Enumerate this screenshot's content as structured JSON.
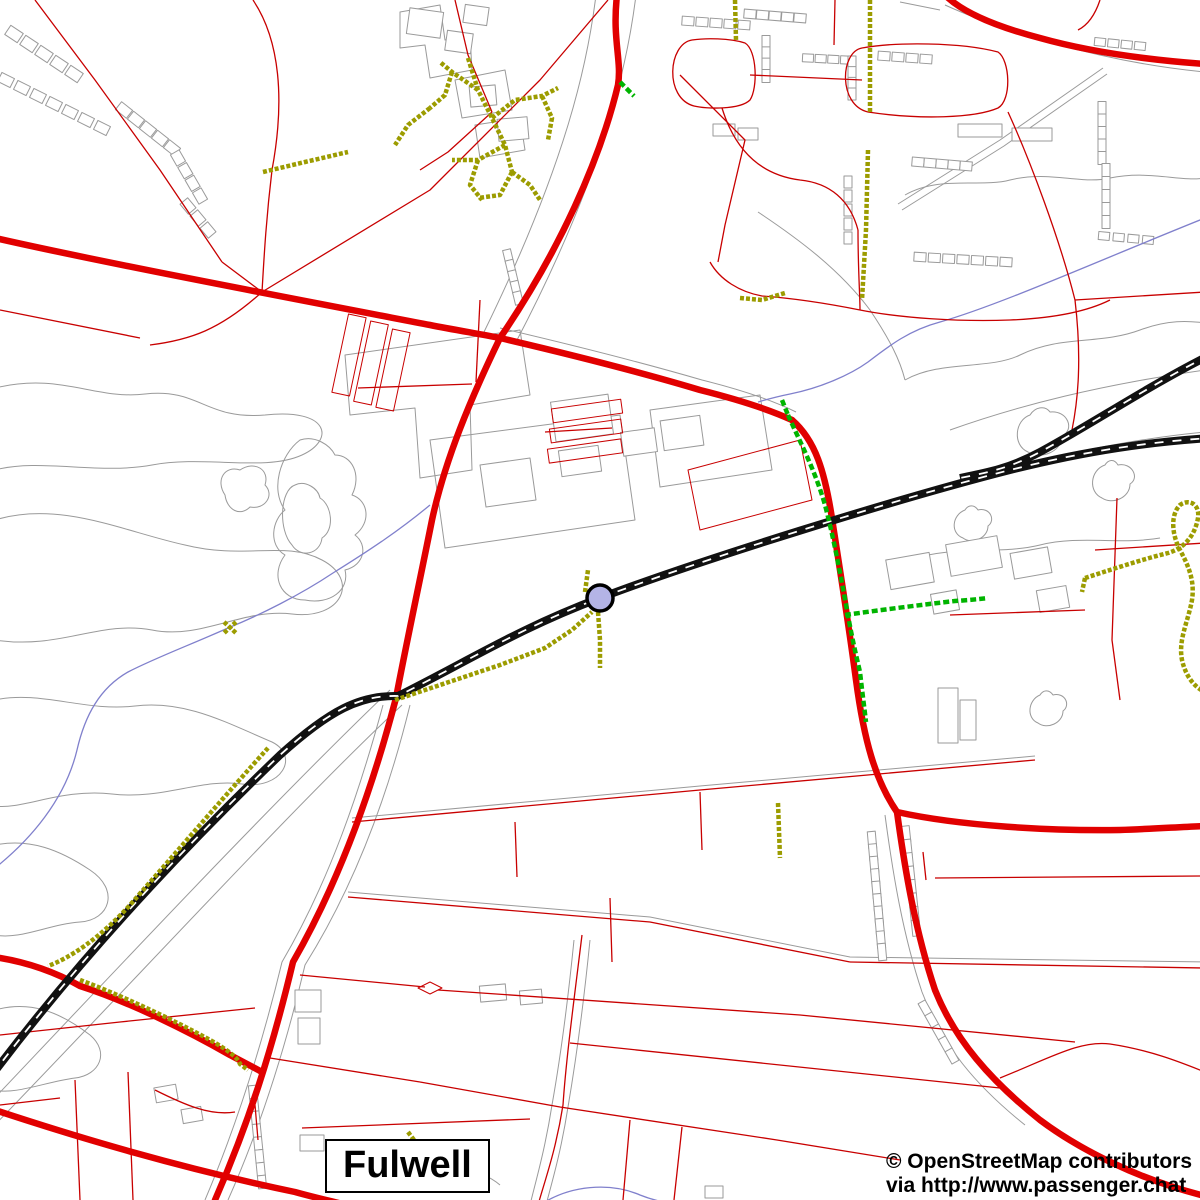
{
  "map": {
    "width": 1200,
    "height": 1200,
    "background": "#ffffff",
    "place_label": "Fulwell",
    "attribution": {
      "line1": "© OpenStreetMap contributors",
      "line2": "via http://www.passenger.chat"
    },
    "station": {
      "name": "railway-station",
      "cx": 600,
      "cy": 598,
      "r": 13,
      "fill": "#b4b4e6",
      "stroke": "#000000",
      "stroke_width": 3.5
    },
    "colors": {
      "road_major": "#e10000",
      "road_minor": "#c80000",
      "path": "#9c9c00",
      "route": "#00b400",
      "railway": "#111111",
      "stream": "#8080cc",
      "outline": "#9a9a9a"
    },
    "layers": [
      {
        "name": "area-outlines",
        "color": "#9a9a9a",
        "width": 1,
        "paths": [
          "M-5,388 C60,372 95,400 145,394 C200,388 205,420 265,415 C330,408 335,440 302,455 C265,472 205,455 152,465 C98,475 40,458 -5,470",
          "M-5,520 C60,500 125,532 185,545 C245,560 285,540 322,560 C360,580 342,620 292,614 C242,608 202,640 152,630 C100,620 60,650 -5,640",
          "M225,495 C215,480 225,465 240,470 C255,460 270,470 265,485 C275,495 265,510 250,507 C240,517 227,510 225,495 Z",
          "M295,485 C280,490 278,530 292,545 C300,558 320,555 322,538 C335,530 332,505 320,498 C318,488 305,480 295,485 Z",
          "M-5,700 C40,690 85,712 135,706 C185,700 225,722 272,742 C300,756 282,790 242,784 C202,778 162,800 112,794 C62,788 22,810 -5,806",
          "M-5,845 C30,838 60,850 90,870 C120,890 110,920 80,922 C50,924 20,940 -5,935",
          "M-5,1010 C30,1000 60,1012 90,1035 C110,1052 100,1075 75,1078 C45,1082 15,1095 -5,1090",
          "M300,440 C280,455 270,490 285,510 C272,520 268,545 285,555 C270,575 280,600 305,600 C330,605 350,590 345,570 C365,565 368,545 355,535 C372,522 368,500 352,495 C362,475 352,455 335,455 C330,445 315,435 300,440 Z",
          "M898,204 L1000,140 L1103,68",
          "M902,210 L1004,146 L1107,74",
          "M905,195 C940,175 980,188 1010,180 C1050,170 1080,185 1110,178 C1150,170 1180,182 1205,178",
          "M758,212 C800,240 840,270 870,310 C890,340 900,360 905,380",
          "M905,380 C940,360 990,370 1020,355 C1060,335 1100,345 1140,330 C1180,315 1205,325 1205,322",
          "M910,560 C950,545 1000,555 1040,545 C1080,535 1120,545 1160,538",
          "M1030,415 C1015,420 1012,445 1028,452 C1040,460 1062,452 1062,436 C1075,430 1068,410 1050,412 C1045,405 1035,407 1030,415 Z",
          "M1105,465 C1090,470 1088,492 1102,498 C1112,505 1130,498 1130,484 C1140,478 1132,462 1118,465 C1114,458 1108,460 1105,465 Z",
          "M965,510 C952,515 950,533 963,538 C972,545 988,538 988,526 C996,520 990,507 978,510 C974,504 968,505 965,510 Z",
          "M1040,695 C1028,700 1026,718 1038,723 C1047,730 1063,723 1063,711 C1071,705 1065,692 1053,695 C1049,689 1043,690 1040,695 Z",
          "M950,430 C1020,405 1100,385 1205,370",
          "M940,490 C1020,462 1120,440 1205,432",
          "M945,5 C1000,30 1100,62 1205,72",
          "M900,2 L940,10",
          "M596,-5 C588,60 568,160 484,332",
          "M636,-5 C628,60 606,170 516,342",
          "M500,328 C560,342 640,362 702,380 C742,390 772,400 796,412",
          "M400,12 L440,5 L445,40 L470,36 L472,70 L430,78 L425,45 L400,48 Z",
          "M455,80 L505,70 L512,110 L462,118 Z",
          "M475,125 L520,118 L525,150 L480,158 Z",
          "M345,355 L520,330 L530,395 L470,405 L472,470 L420,478 L415,408 L350,415 Z",
          "M430,440 L620,415 L635,520 L445,548 Z",
          "M650,410 L760,395 L772,470 L660,487 Z",
          "M480,465 L530,458 L536,500 L486,507 Z",
          "M-12,1105 C130,955 280,795 390,690",
          "M-12,1132 C140,975 300,800 402,705",
          "M352,818 L700,786 L1035,756",
          "M348,892 L650,917 L850,957 L1205,962",
          "M383,705 C360,790 330,880 282,962 C262,1045 238,1122 205,1200",
          "M410,705 C388,795 355,885 305,965 C285,1050 260,1128 228,1200",
          "M885,815 C893,875 903,935 922,992 C942,1045 975,1085 1025,1125",
          "M574,940 C568,1000 560,1060 552,1105 C545,1150 536,1180 530,1205",
          "M590,940 C584,1000 576,1060 568,1107 C561,1152 552,1182 546,1205",
          "M420,1185 C450,1165 480,1168 500,1185"
        ]
      },
      {
        "name": "buildings",
        "color": "#9a9a9a",
        "width": 1,
        "fill": "#ffffff",
        "rects": [
          [
            408,
            10,
            34,
            26,
            8
          ],
          [
            446,
            32,
            26,
            20,
            8
          ],
          [
            464,
            6,
            24,
            18,
            8
          ],
          [
            470,
            86,
            26,
            20,
            -5
          ],
          [
            498,
            118,
            30,
            22,
            -5
          ],
          [
            553,
            398,
            58,
            40,
            -8
          ],
          [
            560,
            448,
            40,
            26,
            -8
          ],
          [
            622,
            430,
            34,
            24,
            -8
          ],
          [
            662,
            418,
            40,
            30,
            -8
          ],
          [
            888,
            556,
            44,
            30,
            -10
          ],
          [
            948,
            540,
            52,
            32,
            -10
          ],
          [
            1012,
            550,
            38,
            26,
            -10
          ],
          [
            932,
            592,
            26,
            20,
            -10
          ],
          [
            1038,
            588,
            30,
            22,
            -10
          ],
          [
            938,
            688,
            20,
            55,
            0
          ],
          [
            960,
            700,
            16,
            40,
            0
          ],
          [
            295,
            990,
            26,
            22,
            0
          ],
          [
            298,
            1018,
            22,
            26,
            0
          ],
          [
            480,
            985,
            26,
            16,
            -5
          ],
          [
            520,
            990,
            22,
            14,
            -5
          ],
          [
            705,
            1186,
            18,
            12,
            0
          ],
          [
            300,
            1135,
            24,
            16,
            0
          ],
          [
            155,
            1086,
            22,
            15,
            -10
          ],
          [
            182,
            1108,
            20,
            14,
            -10
          ],
          [
            713,
            124,
            22,
            12,
            0
          ],
          [
            738,
            128,
            20,
            12,
            0
          ],
          [
            958,
            124,
            44,
            13,
            0
          ],
          [
            1012,
            128,
            40,
            13,
            0
          ]
        ],
        "strips": [
          {
            "x1": 14,
            "y1": 34,
            "x2": 74,
            "y2": 74,
            "n": 5,
            "bw": 15,
            "bh": 11
          },
          {
            "x1": 6,
            "y1": 80,
            "x2": 102,
            "y2": 128,
            "n": 7,
            "bw": 14,
            "bh": 10
          },
          {
            "x1": 124,
            "y1": 110,
            "x2": 172,
            "y2": 148,
            "n": 5,
            "bw": 14,
            "bh": 10
          },
          {
            "x1": 178,
            "y1": 158,
            "x2": 200,
            "y2": 196,
            "n": 4,
            "bw": 13,
            "bh": 10
          },
          {
            "x1": 188,
            "y1": 206,
            "x2": 208,
            "y2": 230,
            "n": 3,
            "bw": 13,
            "bh": 10
          },
          {
            "x1": 688,
            "y1": 21,
            "x2": 744,
            "y2": 25,
            "n": 5,
            "bw": 12,
            "bh": 9
          },
          {
            "x1": 750,
            "y1": 14,
            "x2": 800,
            "y2": 18,
            "n": 5,
            "bw": 12,
            "bh": 9
          },
          {
            "x1": 766,
            "y1": 42,
            "x2": 766,
            "y2": 76,
            "n": 4,
            "bw": 13,
            "bh": 8
          },
          {
            "x1": 808,
            "y1": 58,
            "x2": 846,
            "y2": 60,
            "n": 4,
            "bw": 11,
            "bh": 8
          },
          {
            "x1": 852,
            "y1": 62,
            "x2": 852,
            "y2": 94,
            "n": 4,
            "bw": 12,
            "bh": 8
          },
          {
            "x1": 884,
            "y1": 56,
            "x2": 926,
            "y2": 59,
            "n": 4,
            "bw": 12,
            "bh": 9
          },
          {
            "x1": 918,
            "y1": 162,
            "x2": 966,
            "y2": 166,
            "n": 5,
            "bw": 12,
            "bh": 9
          },
          {
            "x1": 848,
            "y1": 182,
            "x2": 848,
            "y2": 238,
            "n": 5,
            "bw": 12,
            "bh": 8
          },
          {
            "x1": 920,
            "y1": 257,
            "x2": 1006,
            "y2": 262,
            "n": 7,
            "bw": 12,
            "bh": 9
          },
          {
            "x1": 1100,
            "y1": 42,
            "x2": 1140,
            "y2": 46,
            "n": 4,
            "bw": 11,
            "bh": 8
          },
          {
            "x1": 1102,
            "y1": 108,
            "x2": 1102,
            "y2": 158,
            "n": 5,
            "bw": 13,
            "bh": 8
          },
          {
            "x1": 1106,
            "y1": 170,
            "x2": 1106,
            "y2": 222,
            "n": 5,
            "bw": 13,
            "bh": 8
          },
          {
            "x1": 1104,
            "y1": 236,
            "x2": 1148,
            "y2": 240,
            "n": 4,
            "bw": 11,
            "bh": 8
          },
          {
            "x1": 508,
            "y1": 256,
            "x2": 518,
            "y2": 298,
            "n": 5,
            "bw": 13,
            "bh": 8
          },
          {
            "x1": 872,
            "y1": 840,
            "x2": 882,
            "y2": 952,
            "n": 10,
            "bw": 17,
            "bh": 8
          },
          {
            "x1": 906,
            "y1": 834,
            "x2": 916,
            "y2": 928,
            "n": 8,
            "bw": 16,
            "bh": 8
          },
          {
            "x1": 925,
            "y1": 1008,
            "x2": 952,
            "y2": 1056,
            "n": 5,
            "bw": 14,
            "bh": 8
          },
          {
            "x1": 253,
            "y1": 1092,
            "x2": 262,
            "y2": 1182,
            "n": 8,
            "bw": 13,
            "bh": 8
          }
        ]
      },
      {
        "name": "streams",
        "color": "#8080cc",
        "width": 1.3,
        "paths": [
          "M1205,218 C1100,260 1000,305 940,322 C910,330 890,345 868,362 C850,375 820,388 790,394 C775,397 765,400 758,402",
          "M430,505 C400,530 370,550 333,573 C300,595 260,615 228,628 C190,645 155,658 128,672 C100,688 85,715 77,750 C65,800 30,840 -5,868",
          "M540,1205 C570,1185 610,1182 640,1195 C660,1203 680,1205 690,1205"
        ]
      },
      {
        "name": "roads-minor",
        "color": "#c80000",
        "width": 1.3,
        "paths": [
          "M35,0 L95,80 L160,170 L222,262",
          "M253,0 C280,40 285,100 272,170 C266,220 264,258 262,292",
          "M608,0 L540,80 L430,190 L262,292",
          "M262,292 L222,262",
          "M262,292 C220,330 190,340 150,345",
          "M455,0 L468,55 L492,112",
          "M492,112 L448,152 L420,170",
          "M680,75 L745,140 L725,225 L718,262",
          "M750,75 L862,80",
          "M835,0 L834,45",
          "M722,108 C735,150 760,175 800,180 C830,183 850,200 858,230",
          "M858,230 C858,270 860,295 860,310",
          "M860,310 C900,318 960,322 1010,320 C1060,318 1090,310 1110,300",
          "M860,310 C820,302 790,298 762,296 C740,292 720,280 710,262",
          "M1008,112 C1030,160 1060,240 1075,300 C1082,360 1078,400 1072,430",
          "M1075,300 L1205,292",
          "M1100,0 C1095,15 1088,25 1078,30",
          "M1117,498 L1112,640 L1120,700",
          "M1095,550 L1205,543",
          "M950,615 L1085,610",
          "M935,878 L1205,876",
          "M850,962 L1205,968",
          "M1000,1078 C1050,1058 1080,1040 1110,1044 C1150,1050 1180,1062 1205,1072",
          "M352,822 L700,790 L1035,760",
          "M348,897 L650,922 L850,962",
          "M515,822 L517,877",
          "M610,898 L612,962",
          "M700,792 L702,850",
          "M923,852 L926,880",
          "M0,1035 L120,1022 L255,1008",
          "M75,1080 L80,1200",
          "M128,1072 L133,1200",
          "M0,1105 L60,1098",
          "M302,1128 L530,1119",
          "M255,1105 L258,1140",
          "M582,935 C574,1000 566,1060 563,1105 C556,1150 545,1180 538,1205",
          "M300,975 L425,987",
          "M438,990 L800,1015 L1075,1042",
          "M570,1043 L1000,1088",
          "M420,1082 L560,1107 L777,1140 L900,1160",
          "M630,1120 L623,1200",
          "M682,1127 L674,1200",
          "M270,1058 L420,1082",
          "M155,1090 C185,1105 210,1116 235,1112",
          "M358,388 L472,384",
          "M476,382 L480,300",
          "M545,432 L612,428",
          "M0,310 C60,322 100,330 140,338",
          "M692,40 C668,44 664,98 694,106 C706,109 740,110 750,100 C758,88 757,50 745,43 C730,38 705,38 692,40 Z",
          "M862,48 C840,52 838,105 868,112 C920,120 975,118 998,108 C1012,100 1010,60 998,52 C960,42 895,42 862,48 Z"
        ]
      },
      {
        "name": "parcel-outlines",
        "color": "#c80000",
        "width": 1,
        "paths": [
          "M688,470 L800,440 L812,500 L700,530 Z",
          "M430,982 L442,988 L430,994 L418,988 Z"
        ],
        "rects": [
          [
            340,
            315,
            18,
            80,
            12
          ],
          [
            362,
            322,
            18,
            82,
            12
          ],
          [
            384,
            330,
            18,
            80,
            12
          ],
          [
            552,
            404,
            70,
            14,
            -8
          ],
          [
            550,
            424,
            72,
            14,
            -8
          ],
          [
            548,
            444,
            74,
            14,
            -8
          ]
        ]
      },
      {
        "name": "roads-major",
        "color": "#e10000",
        "width": 6.5,
        "linecap": "round",
        "paths": [
          "M617,-5 C612,40 622,60 618,85 C600,160 560,250 500,338",
          "M500,338 C470,400 445,460 432,520 C420,580 405,650 396,698",
          "M396,698 C372,790 340,880 293,962 C272,1050 248,1125 215,1200",
          "M-5,238 C100,262 300,300 430,325 C455,330 480,334 500,338",
          "M500,338 C560,352 640,372 700,390 C740,400 770,410 792,420",
          "M792,420 C815,440 825,470 833,525 C840,570 848,620 856,680 C864,740 875,780 897,812",
          "M897,812 C960,826 1050,831 1120,830 C1150,829 1180,827 1205,826",
          "M897,812 C905,870 915,930 935,990 C955,1040 990,1080 1040,1120 C1080,1150 1140,1180 1205,1196",
          "M945,-5 C960,10 990,25 1040,38 C1090,52 1150,60 1205,64",
          "M0,958 C30,963 55,972 80,986 C130,1002 190,1032 230,1055 C245,1063 255,1068 262,1072",
          "M-5,1110 C80,1138 180,1168 295,1192 C320,1199 340,1203 350,1206"
        ]
      },
      {
        "name": "railway-casing",
        "color": "#111111",
        "width": 8,
        "linecap": "butt",
        "paths": [
          "M-8,1075 C60,985 150,880 280,755 C330,710 360,695 398,696 C470,660 520,628 600,598 C700,560 900,498 1010,470 C1090,450 1150,442 1210,438",
          "M1210,355 C1150,385 1090,425 1040,452 C1010,468 990,472 960,478"
        ]
      },
      {
        "name": "railway-dash",
        "color": "#ffffff",
        "width": 1.8,
        "dash": "9 9",
        "paths": [
          "M-8,1075 C60,985 150,880 280,755 C330,710 360,695 398,696 C470,660 520,628 600,598 C700,560 900,498 1010,470 C1090,450 1150,442 1210,438",
          "M1210,355 C1150,385 1090,425 1040,452 C1010,468 990,472 960,478"
        ]
      },
      {
        "name": "footpaths",
        "color": "#9c9c00",
        "width": 4.5,
        "dash": "4 2",
        "paths": [
          "M468,58 L478,90 L492,118 L505,145 L512,172",
          "M478,90 L452,72 L440,62",
          "M452,72 L445,95 L430,108",
          "M430,108 L408,125 L395,145",
          "M492,118 L515,100 L542,96 L558,88",
          "M542,96 L552,118 L548,140",
          "M505,145 L478,160 L452,160",
          "M478,160 L470,185 L482,200",
          "M512,172 L500,195 L478,198",
          "M512,172 L530,185 L540,200",
          "M735,0 L736,40",
          "M870,0 L870,112",
          "M868,150 L866,230 L862,300",
          "M740,298 L762,300 L785,293",
          "M263,172 L305,162 L348,152",
          "M395,700 L440,685 L500,665 L545,648 L572,630 L592,612",
          "M598,612 L600,640 L600,668",
          "M585,592 L588,570",
          "M268,748 C230,790 180,848 130,905 C100,938 70,958 48,966",
          "M80,980 C120,995 170,1018 210,1040 C228,1050 238,1058 240,1064 L248,1070",
          "M1085,578 C1110,570 1140,560 1168,553 C1185,548 1195,535 1198,518 C1200,505 1190,498 1180,505 C1170,515 1172,535 1180,550 C1188,565 1195,580 1192,600 C1188,622 1178,640 1182,660 C1186,678 1196,688 1205,692",
          "M1085,578 L1082,592",
          "M778,803 L780,858",
          "M224,622 L236,633",
          "M236,622 L224,633",
          "M408,1132 L414,1140"
        ]
      },
      {
        "name": "cycle-routes",
        "color": "#00b400",
        "width": 4.5,
        "dash": "6 3",
        "paths": [
          "M782,400 L788,415",
          "M788,415 C800,442 815,470 825,505 C833,535 840,572 847,610 C852,638 856,655 860,672 C862,690 864,705 866,722",
          "M845,615 C880,610 920,605 955,601 C970,600 980,599 988,598",
          "M620,82 L634,96"
        ]
      }
    ]
  }
}
